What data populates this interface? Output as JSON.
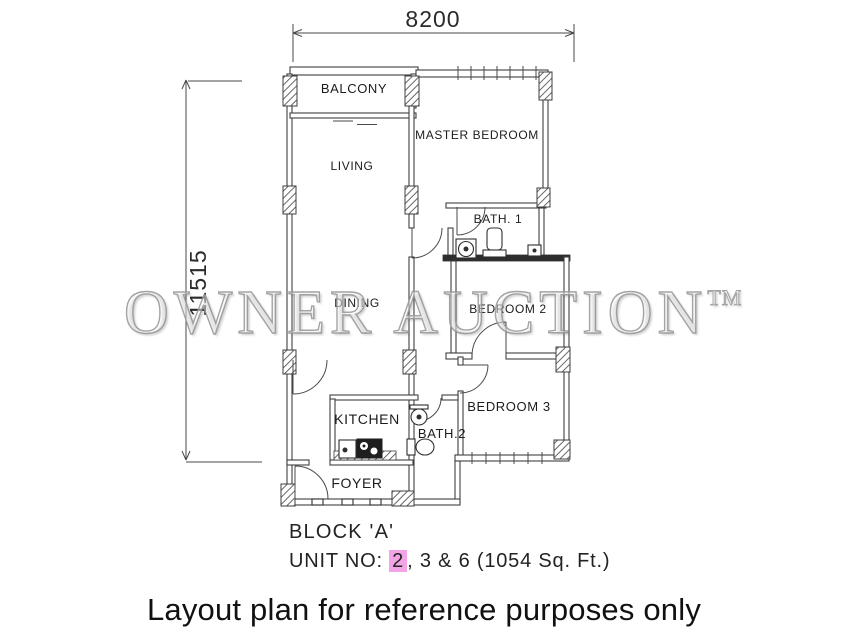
{
  "dimensions": {
    "width": "8200",
    "height": "11515"
  },
  "rooms": [
    {
      "id": "balcony",
      "label": "BALCONY"
    },
    {
      "id": "living",
      "label": "LIVING"
    },
    {
      "id": "master-bedroom",
      "label": "MASTER BEDROOM"
    },
    {
      "id": "bath-1",
      "label": "BATH. 1"
    },
    {
      "id": "dining",
      "label": "DINING"
    },
    {
      "id": "bedroom-2",
      "label": "BEDROOM 2"
    },
    {
      "id": "bedroom-3",
      "label": "BEDROOM 3"
    },
    {
      "id": "kitchen",
      "label": "KITCHEN"
    },
    {
      "id": "bath-2",
      "label": "BATH.2"
    },
    {
      "id": "foyer",
      "label": "FOYER"
    }
  ],
  "watermark": {
    "text": "OWNER AUCTION",
    "tm": "TM"
  },
  "footer": {
    "block_label": "BLOCK 'A'",
    "unit_prefix": "UNIT NO: ",
    "unit_highlighted": "2",
    "unit_rest": ", 3 & 6 (1054 Sq. Ft.)",
    "highlight_color": "#f3a4e6"
  },
  "caption": "Layout plan for reference purposes only",
  "colors": {
    "line": "#3f3f3f",
    "watermark_gray": "#949494",
    "background": "#ffffff"
  }
}
